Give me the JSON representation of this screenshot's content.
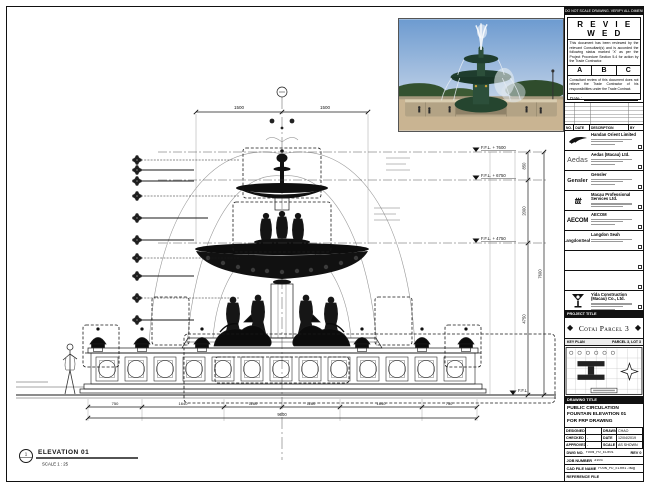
{
  "colors": {
    "paper": "#ffffff",
    "ink": "#1b1b1b",
    "photo_sky": "#6d9bd0",
    "photo_bronze": "#2c4f3a"
  },
  "sheet": {
    "top_note": "DO NOT SCALE DRAWING. VERIFY ALL DIMENSIONS ON SITE BEFORE COMMENCING WORK.",
    "elevation": {
      "tag": "1",
      "title": "ELEVATION 01",
      "scale": "SCALE  1 : 25"
    }
  },
  "stamp": {
    "title": "R E V I E W E D",
    "body": "This document has been reviewed by the relevant Consultant(s) and is accorded the following status marked 'X' as per the Project Procedure Section 5.4 for action by the Trade Contractor.",
    "options": [
      "A",
      "B",
      "C"
    ],
    "note": "Consultant review of this document does not relieve the Trade Contractor of his responsibilities under the Trade Contract.",
    "date_label": "Date :"
  },
  "revisions": {
    "headers": [
      "NO.",
      "DATE",
      "DESCRIPTION",
      "BY"
    ]
  },
  "companies": [
    {
      "name": "Handan Orient Limited"
    },
    {
      "logo_text": "Aedas",
      "name": "Aedas (Macau) Ltd."
    },
    {
      "logo_text": "Gensler",
      "name": "Gensler"
    },
    {
      "logo_text": "ttt",
      "name": "Macau Professional Services Ltd."
    },
    {
      "logo_text": "AECOM",
      "name": "AECOM"
    },
    {
      "logo_text": "LangdonSeah",
      "name": "Langdon Seah"
    },
    {
      "name": ""
    },
    {
      "name": ""
    },
    {
      "name": "Yida Construction (Macau) Co., Ltd."
    }
  ],
  "project": {
    "bar_label": "PROJECT TITLE",
    "title": "Cotai Parcel 3"
  },
  "key_plan": {
    "label": "KEY PLAN",
    "parcel_label": "PARCEL 3, LOT 3"
  },
  "drawing": {
    "bar_label": "DRAWING TITLE",
    "title_lines": [
      "PUBLIC CIRCULATION",
      "FOUNTAIN ELEVATION 01",
      "FOR FRP DRAWING"
    ],
    "table": {
      "designed_label": "DESIGNED",
      "designed": "",
      "drawn_label": "DRAWN",
      "drawn": "CHAO",
      "checked_label": "CHECKED",
      "checked": "-",
      "date_label": "DATE",
      "date": "12/04/2019",
      "approved_label": "APPROVED",
      "approved": "-",
      "scale_label": "SCALE",
      "scale": "AS SHOWN"
    },
    "dwg_no_label": "DWG NO.",
    "dwg_no": "FOUN_PD_EL001",
    "rev": "REV 0",
    "job_label": "JOB NUMBER",
    "job": "3103",
    "cad_label": "CAD FILE NAME",
    "cad": "FOUN_PD_EL001.dwg",
    "ref_label": "REFERENCE FILE",
    "ref": ""
  },
  "drawing_annotations": {
    "levels": [
      "F.F.L. + 7600",
      "F.F.L. + 6750",
      "F.F.L. + 4750",
      "F.F.L."
    ],
    "right_dims": [
      "850",
      "2000",
      "4750",
      "7600"
    ],
    "top_dims": [
      "1500",
      "1500"
    ],
    "bottom_dims": [
      "750",
      "1640",
      "1160",
      "1160",
      "1640",
      "750"
    ],
    "overall_dim": "9600"
  }
}
